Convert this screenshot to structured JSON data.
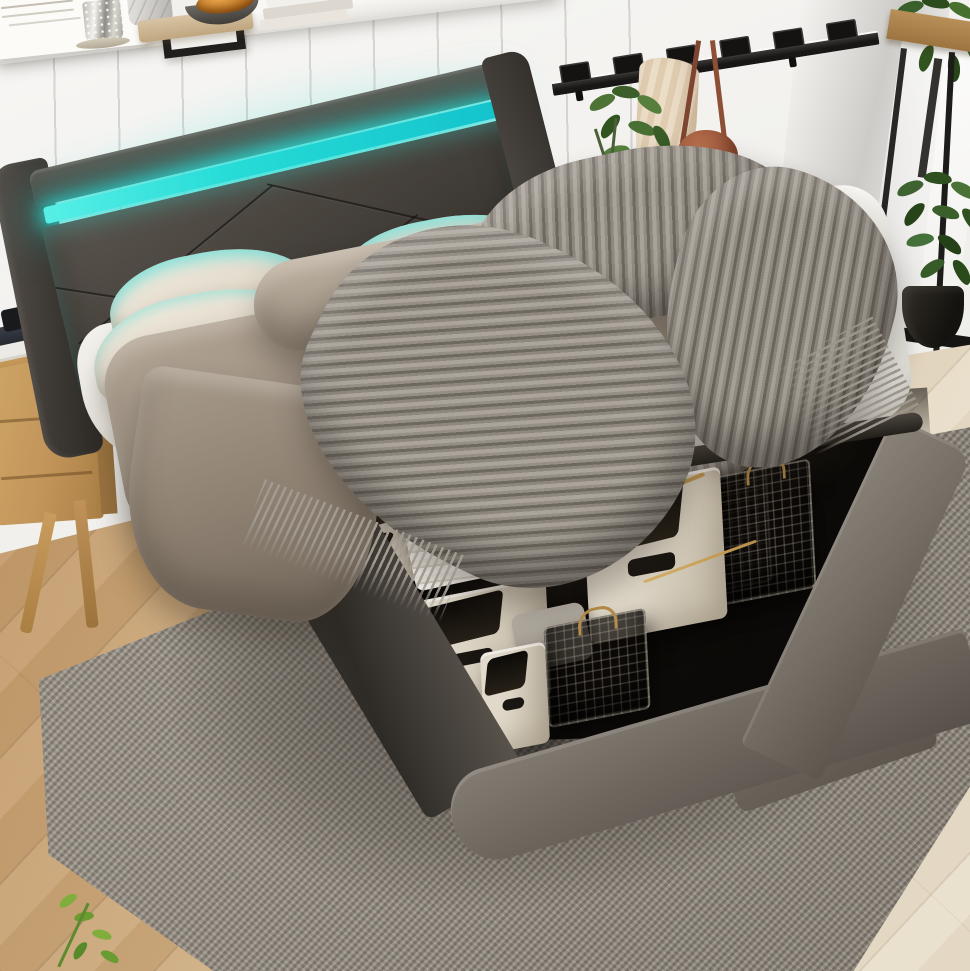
{
  "meta": {
    "title": "Lifestyle product photo: gray upholstered platform storage bed with cyan LED headboard, lifted mattress revealing under-bed storage bins",
    "type": "product-photo-render",
    "visible_text": "none"
  },
  "palette": {
    "wall": "#f3f2ef",
    "shelf": "#f9f8f6",
    "led": "#27dcd7",
    "hb_dark": "#49443e",
    "hb_mid": "#46413b",
    "mattress": "#f8f7f4",
    "pillow": "#e2dacb",
    "blanket": "#9d9081",
    "blanket_dark": "#70655a",
    "throw": "#a8a299",
    "throw_dark": "#6e6960",
    "frame": "#6f685f",
    "frame_light": "#847d74",
    "frame_dark": "#3c3833",
    "storage": "#0f0d0a",
    "bin": "#dcd4c4",
    "bin_dark": "#bcb2a0",
    "gold": "#b68d4a",
    "wood": "#c79e6d",
    "wood_light": "#e0d3ba",
    "rug": "#918a80",
    "oak": "#c09354",
    "oak_dark": "#a97f45",
    "scarf": "#ecddc7",
    "bag": "#9a553a",
    "rack": "#181716"
  },
  "scene": {
    "wall": {
      "label": "white vertical shiplap wall with corner shadow and window light"
    },
    "shelf": {
      "label": "white floating shelf with decor",
      "items": [
        "handwritten art board",
        "black picture frame",
        "mercury glass candle holder",
        "marble canister",
        "wooden tray",
        "amber glass dish on dark bowl",
        "stack of books"
      ]
    },
    "coat_rack": {
      "label": "black flip-hook wall coat rack",
      "hooks": 6,
      "hanging": [
        "cream knit scarf",
        "rust leather crossbody bag"
      ]
    },
    "plants": {
      "left": "green plant with white jug vase and sphere decor behind headboard",
      "stand": "black metal plant stand with wood shelf and trailing greenery",
      "floor": "leafy plant in black tapered pot"
    },
    "bed": {
      "label": "queen upholstered platform bed, dark gray faux leather",
      "headboard": "wingback headboard with diagonal stitching and glowing cyan LED light strip",
      "mattress": "white mattress lifted upward on hydraulic struts",
      "pillows": 4,
      "bedding": [
        "taupe fleece blanket",
        "gray ribbed knit throw with fringe",
        "cream pillows with cyan LED glow"
      ]
    },
    "storage": {
      "label": "under-bed hydraulic lift storage compartment",
      "fabric_bins": [
        {
          "color": "cream",
          "position": "far-left partial"
        },
        {
          "color": "cream",
          "position": "far row with handle slot"
        },
        {
          "color": "cream",
          "position": "center large"
        },
        {
          "color": "cream",
          "position": "front-left large"
        },
        {
          "color": "cream",
          "position": "front small"
        }
      ],
      "wire_baskets": [
        {
          "color": "black",
          "handles": "brass",
          "contents": "taupe rolled blanket"
        },
        {
          "color": "black",
          "handles": "brass",
          "contents": "gray knit roll"
        },
        {
          "color": "black",
          "handles": "brass",
          "contents": "folded linens"
        },
        {
          "color": "black",
          "handles": "brass",
          "contents": "empty"
        }
      ],
      "loose_items": [
        "striped folded linen stack",
        "gray seat pad"
      ]
    },
    "furniture": {
      "nightstand": "light oak two-drawer nightstand with splayed legs, stacked books and black gadget"
    },
    "floor": {
      "label": "light oak diagonal plank floor, brighter toward lower right"
    },
    "rug": {
      "label": "gray heathered woven area rug under bed"
    }
  }
}
